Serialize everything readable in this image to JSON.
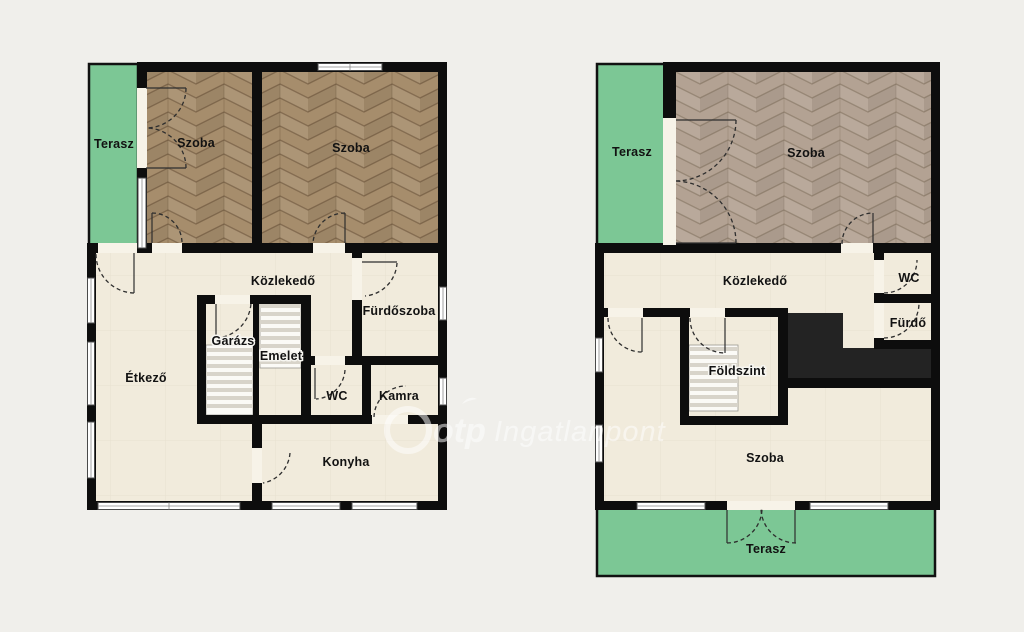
{
  "watermark": {
    "brand": "otp",
    "name": "Ingatlanpont"
  },
  "colors": {
    "background": "#f0efeb",
    "wall": "#0d0d0d",
    "floor_cream": "#f1ebdc",
    "terrace_green": "#7cc795",
    "parquet_left_plan": "#a68d6c",
    "parquet_right_plan": "#b3a293",
    "dark_block": "#232323",
    "watermark_text": "#ffffff"
  },
  "plans": {
    "left": {
      "rooms": {
        "terasz": "Terasz",
        "szoba1": "Szoba",
        "szoba2": "Szoba",
        "kozlekedo": "Közlekedő",
        "furdoszoba": "Fürdőszoba",
        "etkezo": "Étkező",
        "garazs": "Garázs",
        "emelet": "Emelet",
        "wc": "WC",
        "kamra": "Kamra",
        "konyha": "Konyha"
      }
    },
    "right": {
      "rooms": {
        "terasz_top": "Terasz",
        "szoba_top": "Szoba",
        "kozlekedo": "Közlekedő",
        "wc": "WC",
        "furdo": "Fürdő",
        "foldszint": "Földszint",
        "szoba_bottom": "Szoba",
        "terasz_bottom": "Terasz"
      }
    }
  }
}
